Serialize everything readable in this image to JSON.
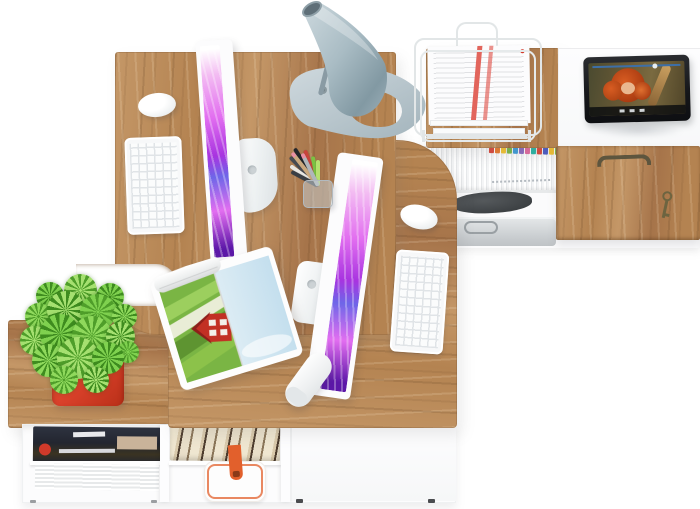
{
  "meta": {
    "title": "Office workspace furniture set — top view product render",
    "canvas": {
      "width": 700,
      "height": 509
    }
  },
  "scene": {
    "background": "#ffffff",
    "colors": {
      "wood_a": "#c49767",
      "wood_b": "#b48351",
      "wood_c": "#a6744a",
      "screen_s1": "#f3bcf2",
      "screen_s2": "#e26ef0",
      "screen_s3": "#a834e0",
      "screen_s4": "#6e66e8",
      "screen_s5": "#5c17a8",
      "pot_red": "#d8402a",
      "strap_orange": "#e2602c",
      "accent_red": "#d03a2a",
      "paper_stripe": "#e2655c",
      "hair_orange": "#d85c22",
      "lamp_light": "#d6e0e5",
      "lamp_mid": "#9fb2bb",
      "lamp_dark": "#7f939d"
    },
    "labels": {
      "desk_left": "left oak desk with computer workstation",
      "desk_right": "right oak return desk with second workstation",
      "sideboard_right": "white sideboard with oak door, file shelf and key",
      "cabinet_bottom": "low white cabinet with oak top, magazines, books and bag",
      "monitor1": "all-in-one computer monitor (top view)",
      "monitor2": "second all-in-one computer monitor (top view)",
      "keyboard1": "white wireless keyboard",
      "keyboard2": "white wireless keyboard",
      "mouse1": "white computer mouse",
      "mouse2": "white computer mouse",
      "lamp": "silver cone desk lamp",
      "pen_cup": "mesh cup with pens and pencils",
      "basket": "white wire document basket with papers",
      "tablet": "tablet playing an animated movie",
      "plant": "succulent plant in red square pot",
      "magazine_open": "open magazine with red barn photo spread",
      "magazine_stack": "stack of magazines on shelf",
      "book_row": "row of books on shelf",
      "shop_bag": "white gift bag with orange trim",
      "briefcase": "grey briefcase on cabinet shelf",
      "dark_bag": "dark pouch on cabinet shelf",
      "wood_door": "oak cabinet door with handle and key",
      "white_door": "plain white cabinet door",
      "remote": "white remote control",
      "files": "file folders with colored index tabs"
    },
    "file_tabs": [
      "#d9483b",
      "#e87a2e",
      "#f2c230",
      "#7ab648",
      "#3f9bd8",
      "#8a6bbf",
      "#e06a9e",
      "#2ab5a5",
      "#d9483b",
      "#4a5bc4",
      "#f2c230",
      "#7ab648"
    ],
    "pens": [
      {
        "c": "#474b52",
        "a": -44,
        "l": 40
      },
      {
        "c": "#23262b",
        "a": -32,
        "l": 44
      },
      {
        "c": "#c8453c",
        "a": -20,
        "l": 38
      },
      {
        "c": "#e9e7e3",
        "a": -54,
        "l": 34
      },
      {
        "c": "#caa87e",
        "a": -38,
        "l": 42,
        "tip": "#e890a4"
      },
      {
        "c": "#7cc143",
        "a": -10,
        "l": 30
      },
      {
        "c": "#b6e06e",
        "a": 0,
        "l": 26
      },
      {
        "c": "#3a3e44",
        "a": -62,
        "l": 30
      },
      {
        "c": "#b0b6ba",
        "a": -26,
        "l": 36,
        "tip": "#e890a4"
      }
    ],
    "plant": {
      "spikes": [
        {
          "x": 50,
          "y": 296,
          "s": 28,
          "r": 0,
          "c1": "#3e8c1f",
          "c2": "#7fd14f"
        },
        {
          "x": 80,
          "y": 290,
          "s": 33,
          "r": 20,
          "c1": "#4f9e2a",
          "c2": "#a5e070"
        },
        {
          "x": 110,
          "y": 297,
          "s": 28,
          "r": 40,
          "c1": "#3e8c1f",
          "c2": "#7fd14f"
        },
        {
          "x": 38,
          "y": 316,
          "s": 27,
          "r": 10,
          "c1": "#4f9e2a",
          "c2": "#8fd95c"
        },
        {
          "x": 66,
          "y": 310,
          "s": 38,
          "r": 30,
          "c1": "#3e8c1f",
          "c2": "#a5e070"
        },
        {
          "x": 98,
          "y": 312,
          "s": 36,
          "r": 50,
          "c1": "#4f9e2a",
          "c2": "#7fd14f"
        },
        {
          "x": 124,
          "y": 316,
          "s": 25,
          "r": 15,
          "c1": "#3e8c1f",
          "c2": "#8fd95c"
        },
        {
          "x": 34,
          "y": 340,
          "s": 29,
          "r": 25,
          "c1": "#4f9e2a",
          "c2": "#a5e070"
        },
        {
          "x": 60,
          "y": 334,
          "s": 40,
          "r": 45,
          "c1": "#3e8c1f",
          "c2": "#7fd14f"
        },
        {
          "x": 92,
          "y": 336,
          "s": 40,
          "r": 5,
          "c1": "#4f9e2a",
          "c2": "#8fd95c"
        },
        {
          "x": 120,
          "y": 336,
          "s": 29,
          "r": 35,
          "c1": "#3e8c1f",
          "c2": "#a5e070"
        },
        {
          "x": 128,
          "y": 352,
          "s": 22,
          "r": 55,
          "c1": "#4f9e2a",
          "c2": "#7fd14f"
        },
        {
          "x": 48,
          "y": 360,
          "s": 33,
          "r": 15,
          "c1": "#3e8c1f",
          "c2": "#8fd95c"
        },
        {
          "x": 78,
          "y": 358,
          "s": 42,
          "r": 35,
          "c1": "#4f9e2a",
          "c2": "#a5e070"
        },
        {
          "x": 108,
          "y": 358,
          "s": 32,
          "r": 60,
          "c1": "#3e8c1f",
          "c2": "#7fd14f"
        },
        {
          "x": 64,
          "y": 380,
          "s": 28,
          "r": 8,
          "c1": "#4f9e2a",
          "c2": "#8fd95c"
        },
        {
          "x": 96,
          "y": 380,
          "s": 26,
          "r": 28,
          "c1": "#3e8c1f",
          "c2": "#a5e070"
        }
      ]
    }
  }
}
